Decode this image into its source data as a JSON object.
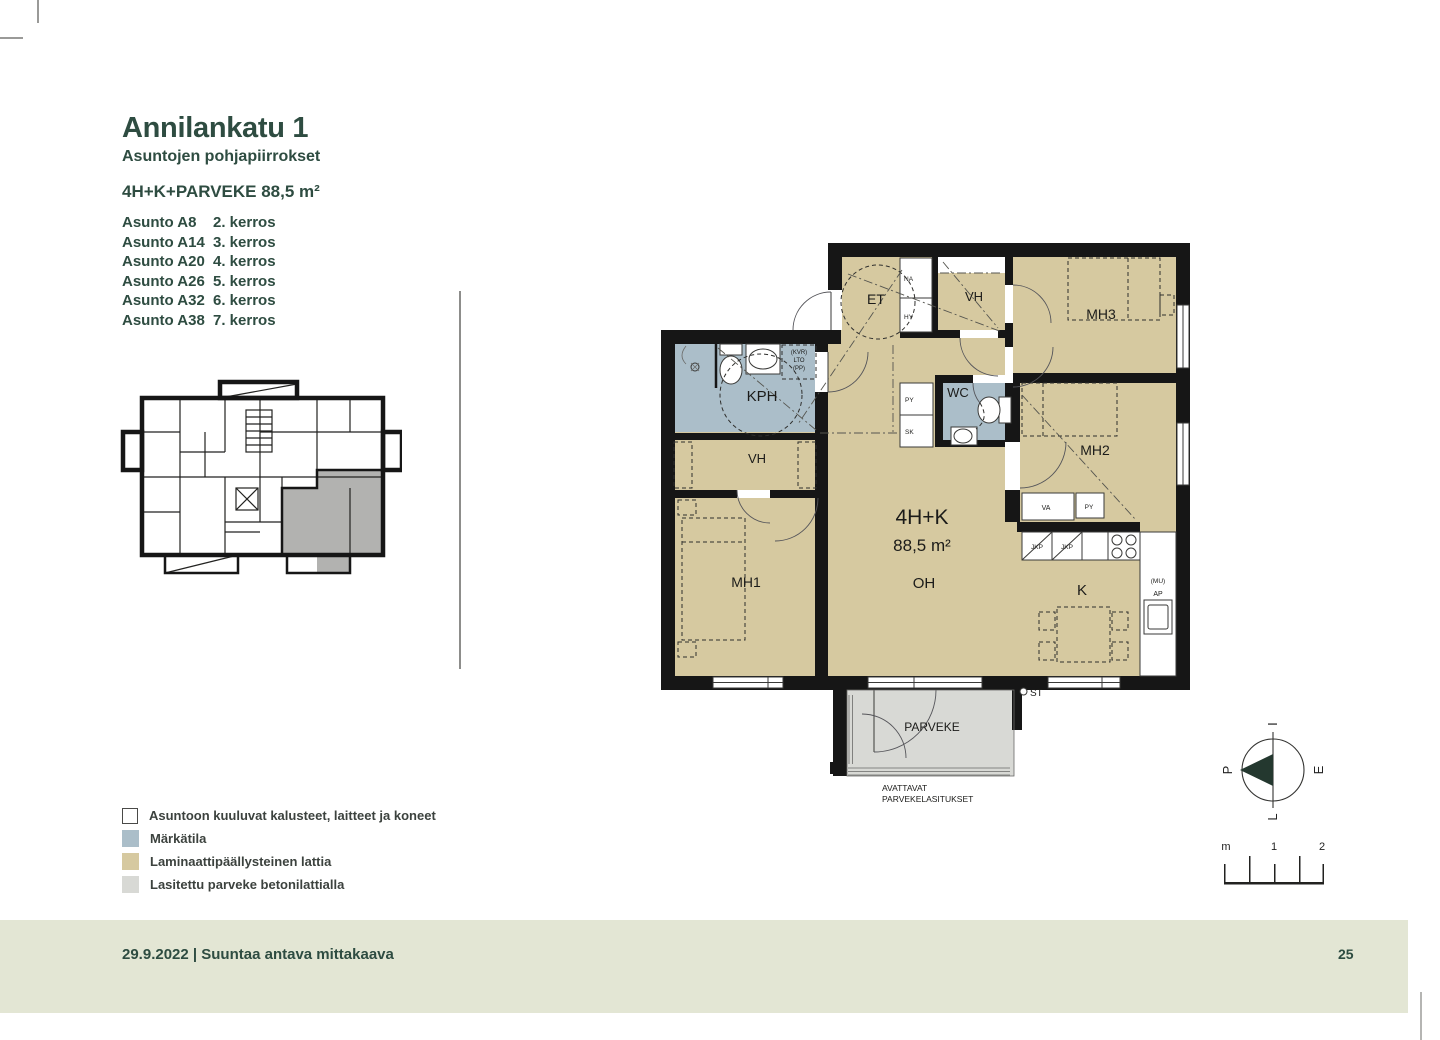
{
  "colors": {
    "accent": "#2e4c41",
    "wall": "#161616",
    "room_tan": "#d6c9a0",
    "wet_blue": "#abbec9",
    "balcony_gray": "#d8d9d5",
    "footer_band": "#e3e6d4",
    "highlight_gray": "#b2b2b0"
  },
  "header": {
    "title": "Annilankatu 1",
    "subtitle": "Asuntojen pohjapiirrokset",
    "apartment_type": "4H+K+PARVEKE 88,5 m²",
    "apartments": [
      {
        "name": "Asunto A8",
        "floor": "2. kerros"
      },
      {
        "name": "Asunto A14",
        "floor": "3. kerros"
      },
      {
        "name": "Asunto A20",
        "floor": "4. kerros"
      },
      {
        "name": "Asunto A26",
        "floor": "5. kerros"
      },
      {
        "name": "Asunto A32",
        "floor": "6. kerros"
      },
      {
        "name": "Asunto A38",
        "floor": "7. kerros"
      }
    ]
  },
  "legend": {
    "items": [
      {
        "label": "Asuntoon kuuluvat kalusteet, laitteet ja koneet",
        "swatch": "#ffffff"
      },
      {
        "label": "Märkätila",
        "swatch": "#abbec9"
      },
      {
        "label": "Laminaattipäällysteinen lattia",
        "swatch": "#d6c9a0"
      },
      {
        "label": "Lasitettu parveke betonilattialla",
        "swatch": "#d8d9d5"
      }
    ]
  },
  "plan": {
    "labels": {
      "et": "ET",
      "vh_top": "VH",
      "mh3": "MH3",
      "wc": "WC",
      "kph": "KPH",
      "vh_lower": "VH",
      "mh1": "MH1",
      "mh2": "MH2",
      "type": "4H+K",
      "area": "88,5 m²",
      "oh": "OH",
      "kitchen": "K",
      "balcony": "PARVEKE",
      "na": "NA",
      "hy": "HY",
      "py": "PY",
      "sk": "SK",
      "va": "VA",
      "py2": "PY",
      "jkp1": "JKP",
      "jkp2": "JKP",
      "mu": "(MU)",
      "ap": "AP",
      "st": "ST",
      "kvr": "(KVR)",
      "lto": "LTO",
      "pp": "(PP)",
      "note1": "AVATTAVAT",
      "note2": "PARVEKELASITUKSET"
    }
  },
  "compass": {
    "left": "P",
    "top": "I",
    "right": "E",
    "bottom": "L"
  },
  "scalebar": {
    "unit": "m",
    "mid": "1",
    "end": "2"
  },
  "footer": {
    "text": "29.9.2022 | Suuntaa antava mittakaava",
    "page_number": "25"
  }
}
